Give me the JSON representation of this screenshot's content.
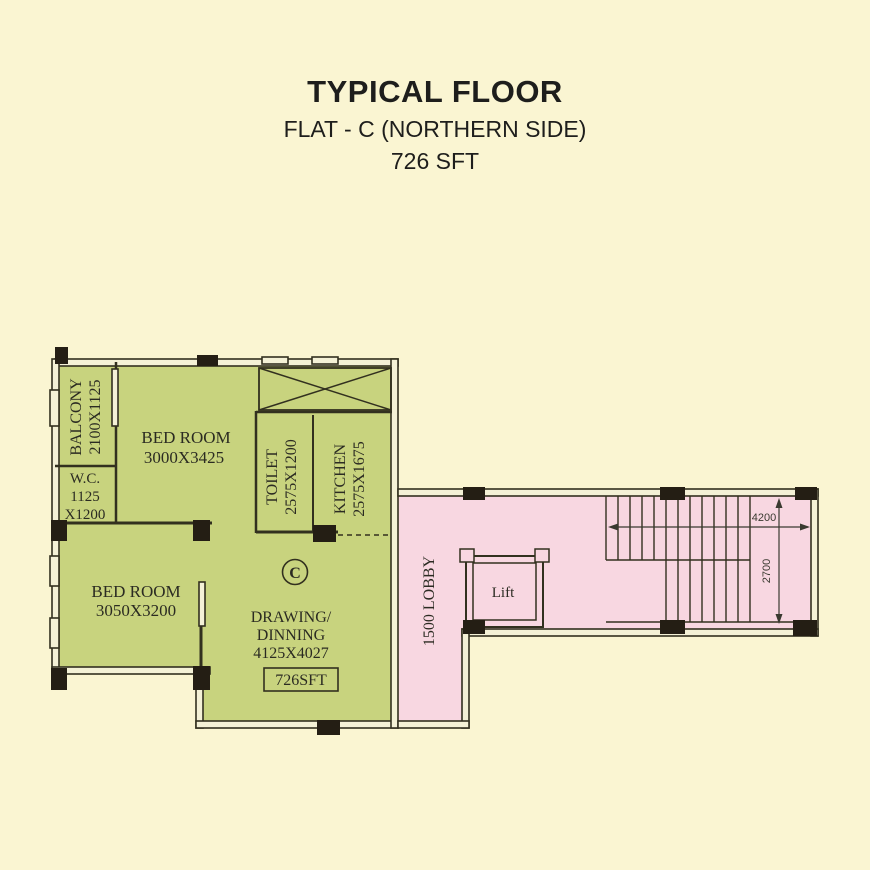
{
  "title": {
    "line1": "TYPICAL FLOOR",
    "line2": "FLAT - C (NORTHERN SIDE)",
    "line3": "726 SFT"
  },
  "flat_label": "C",
  "rooms": {
    "balcony": {
      "name": "BALCONY",
      "dim": "2100X1125"
    },
    "wc": {
      "name": "W.C.",
      "dim1": "1125",
      "dim2": "X1200"
    },
    "bedroom1": {
      "name": "BED ROOM",
      "dim": "3000X3425"
    },
    "bedroom2": {
      "name": "BED ROOM",
      "dim": "3050X3200"
    },
    "toilet": {
      "name": "TOILET",
      "dim": "2575X1200"
    },
    "kitchen": {
      "name": "KITCHEN",
      "dim": "2575X1675"
    },
    "drawing": {
      "name1": "DRAWING/",
      "name2": "DINNING",
      "dim": "4125X4027",
      "area": "726SFT"
    },
    "lobby": {
      "name": "1500 LOBBY"
    },
    "lift": {
      "name": "Lift"
    }
  },
  "dimensions": {
    "stair_width": "4200",
    "stair_depth": "2700"
  },
  "colors": {
    "background": "#faf5d2",
    "flat_fill": "#c8d37e",
    "lobby_fill": "#f8d7e1",
    "wall": "#32301f",
    "column": "#241e14"
  }
}
